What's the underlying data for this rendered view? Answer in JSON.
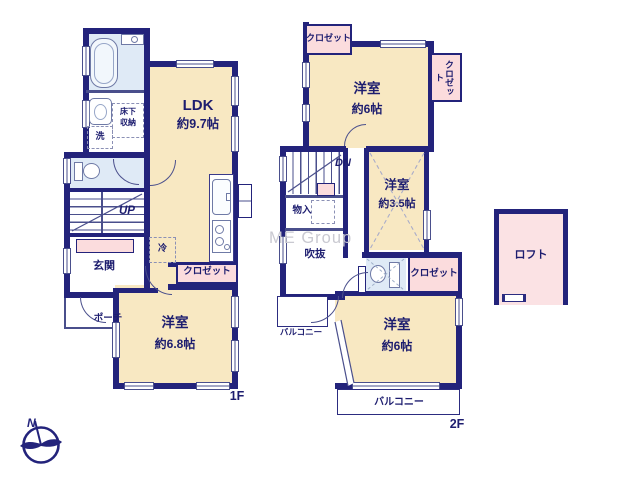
{
  "meta": {
    "f1_label": "1F",
    "f2_label": "2F",
    "watermark": "ME Group",
    "north": "N"
  },
  "f1": {
    "ldk": "LDK",
    "ldk_size": "約9.7帖",
    "room": "洋室",
    "room_size": "約6.8帖",
    "entrance": "玄関",
    "porch": "ポーチ",
    "stairs": "UP",
    "washer": "洗",
    "underfloor1": "床下",
    "underfloor2": "収納",
    "fridge": "冷",
    "closet": "クロゼット"
  },
  "f2": {
    "room_top": "洋室",
    "room_top_size": "約6帖",
    "room_mid": "洋室",
    "room_mid_size": "約3.5帖",
    "room_bottom": "洋室",
    "room_bottom_size": "約6帖",
    "closet_top_left": "クロゼット",
    "closet_right": "クロゼット",
    "closet_mid": "クロゼット",
    "storage": "物入",
    "void": "吹抜",
    "stairs": "DN",
    "balcony_bottom": "バルコニー",
    "balcony_left": "バルコニー",
    "loft": "ロフト"
  },
  "colors": {
    "wall": "#23237b",
    "line": "#4a4f8c",
    "room": "#f8e8c2",
    "closet": "#fbdcdd",
    "wet": "#dfeaf6",
    "loft": "#fbe2e4",
    "label": "#1d1d6f",
    "watermark": "#c9c9d1"
  }
}
